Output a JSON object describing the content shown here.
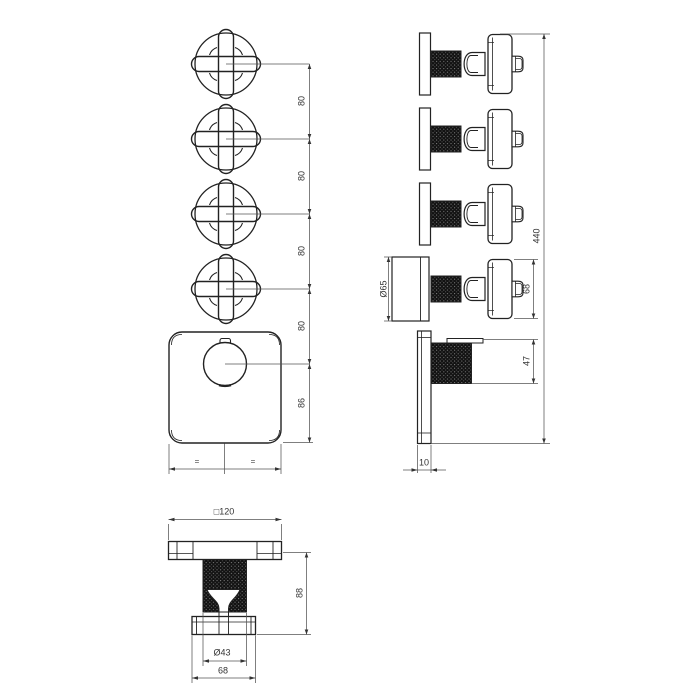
{
  "dimensions": {
    "front": {
      "spacings": [
        "80",
        "80",
        "80",
        "80"
      ],
      "center_to_bottom": "86",
      "equal_marks": [
        "=",
        "="
      ]
    },
    "side": {
      "rosette_diameter": "Ø65",
      "handle_height": "68",
      "total_height": "440",
      "knob_height": "47",
      "plate_thickness": "10"
    },
    "bottom": {
      "plate_size": "□120",
      "depth": "88",
      "hub_diameter": "Ø43",
      "handle_width": "68"
    }
  }
}
